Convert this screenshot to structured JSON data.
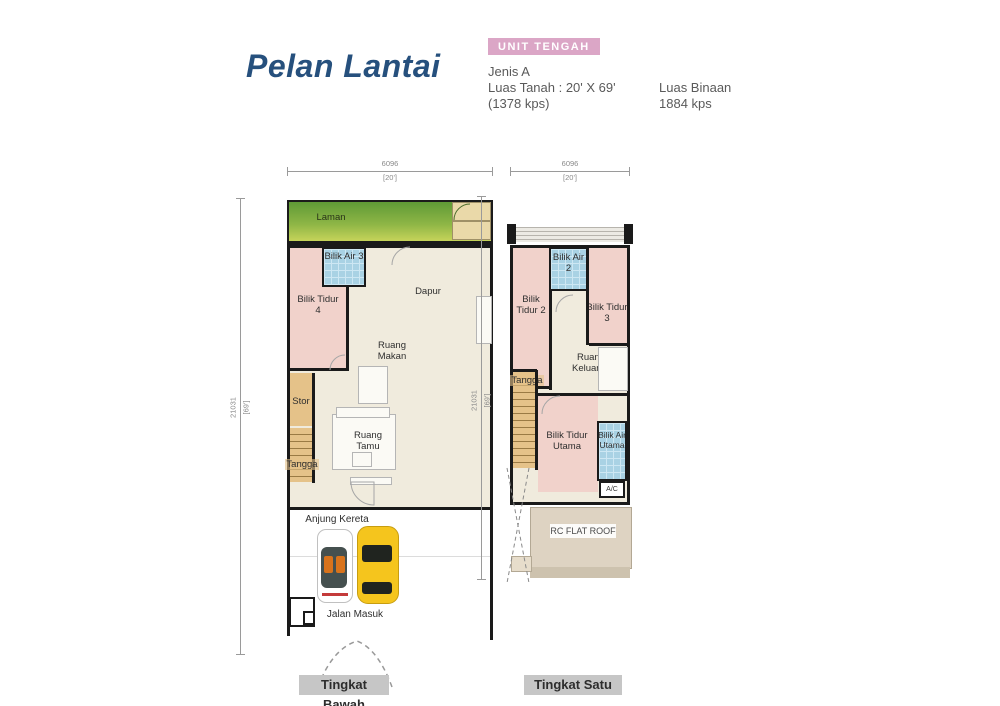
{
  "header": {
    "title": "Pelan Lantai",
    "unit_badge": "UNIT TENGAH",
    "type_label": "Jenis A",
    "land_area_label": "Luas Tanah : 20' X 69'",
    "land_area_sqft": "(1378 kps)",
    "built_up_label": "Luas Binaan",
    "built_up_value": "1884 kps"
  },
  "colors": {
    "title_blue": "#26507d",
    "badge_pink": "#dba6c6",
    "room_pink": "#f1d2cb",
    "room_cream": "#f0ebdd",
    "bath_blue": "#a9d2e4",
    "stair_tan": "#e5c289",
    "garden_green_top": "#5f9a36",
    "garden_green_bottom": "#cdd75c",
    "roof_beige": "#ded3c2",
    "wall_black": "#1a1a1a",
    "caption_gray": "#c6c6c6"
  },
  "ground_floor": {
    "caption": "Tingkat Bawah",
    "dim_width": "6096",
    "dim_width_ft": "[20']",
    "dim_depth": "21031",
    "dim_depth_ft": "[69']",
    "rooms": {
      "laman": "Laman",
      "bilik_air_3": "Bilik Air 3",
      "bilik_tidur_4": "Bilik Tidur 4",
      "dapur": "Dapur",
      "ruang_makan": "Ruang Makan",
      "stor": "Stor",
      "tangga": "Tangga",
      "ruang_tamu": "Ruang Tamu",
      "anjung_kereta": "Anjung Kereta",
      "jalan_masuk": "Jalan Masuk"
    }
  },
  "first_floor": {
    "caption": "Tingkat Satu",
    "dim_width": "6096",
    "dim_width_ft": "[20']",
    "dim_depth": "21031",
    "dim_depth_ft": "[69']",
    "rooms": {
      "bilik_air_2": "Bilik Air 2",
      "bilik_tidur_2": "Bilik Tidur 2",
      "bilik_tidur_3": "Bilik Tidur 3",
      "ruang_keluarga": "Ruang Keluarga",
      "tangga": "Tangga",
      "bilik_tidur_utama": "Bilik Tidur Utama",
      "bilik_air_utama": "Bilik Air Utama",
      "ac": "A/C",
      "rc_flat_roof": "RC FLAT ROOF"
    }
  }
}
